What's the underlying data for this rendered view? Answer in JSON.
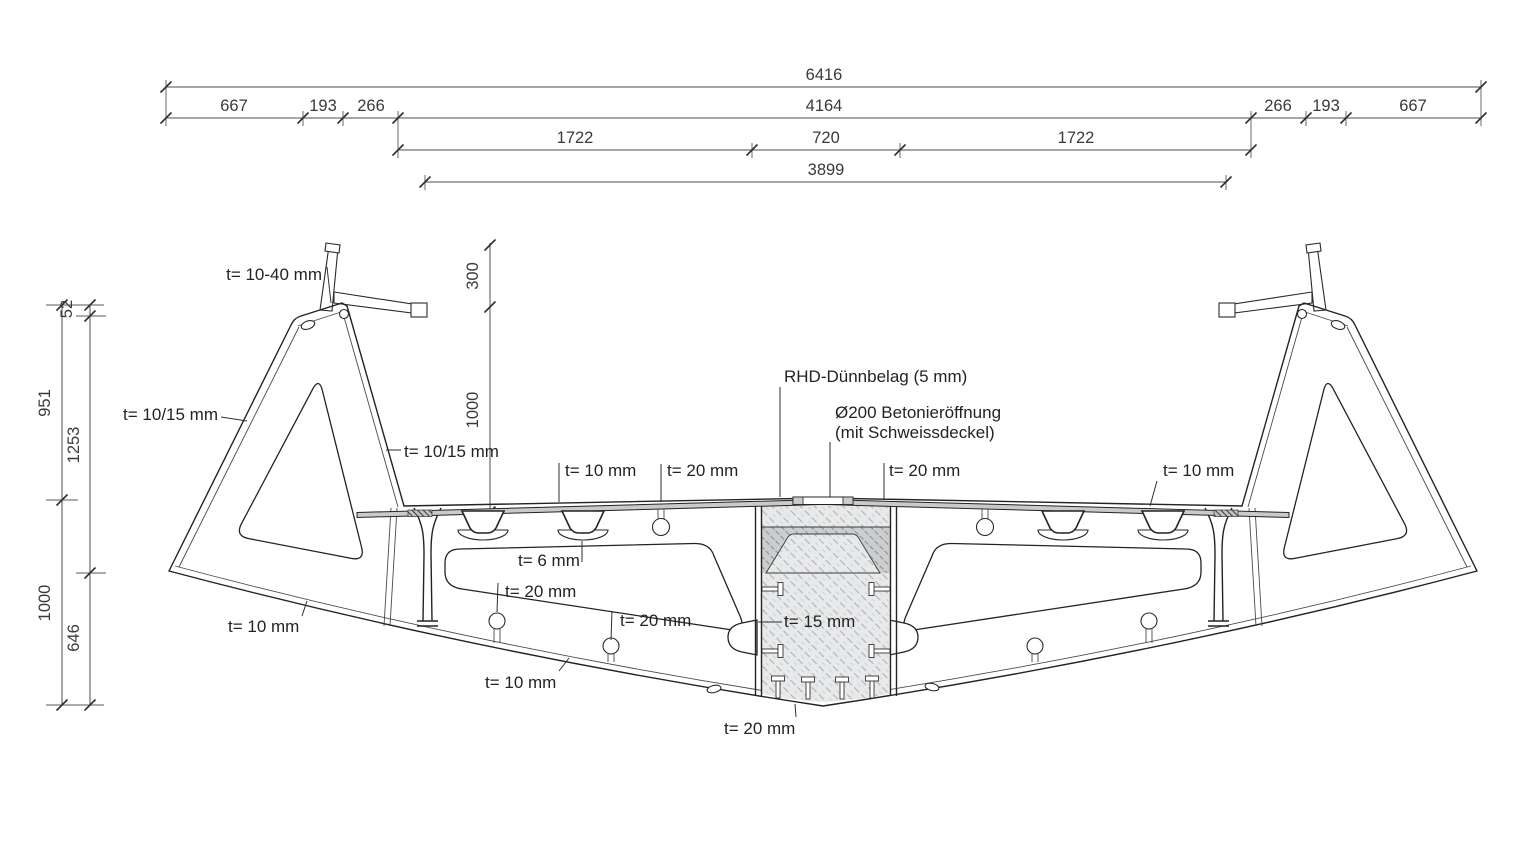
{
  "drawing_type": "bridge box-girder cross-section, dimensioned engineering drawing",
  "colors": {
    "background": "#ffffff",
    "steel_fill": "#d9dadb",
    "deck_fill": "#c8cacc",
    "outline": "#232323",
    "dimension_line": "#4c4c4c",
    "text": "#3a3a3a"
  },
  "dimensions": {
    "top": {
      "overall": "6416",
      "row2": [
        "667",
        "193",
        "266",
        "4164",
        "266",
        "193",
        "667"
      ],
      "row3": [
        "1722",
        "720",
        "1722"
      ],
      "row4": "3899"
    },
    "left": {
      "outer": [
        "951",
        "1000"
      ],
      "inner": [
        "52",
        "1253",
        "646"
      ]
    },
    "middle": [
      "300",
      "1000"
    ]
  },
  "labels": {
    "t_top_plate": "t= 10-40 mm",
    "t_outer_web_left": "t= 10/15 mm",
    "t_inner_web_left": "t= 10/15 mm",
    "t_deck_left": "t= 10 mm",
    "t_rib_deck_left": "t= 20 mm",
    "surfacing": "RHD-Dünnbelag (5 mm)",
    "opening_line1": "Ø200 Betonieröffnung",
    "opening_line2": "(mit Schweissdeckel)",
    "t_deck_center_right": "t= 20 mm",
    "t_deck_right": "t= 10 mm",
    "t_trough": "t= 6 mm",
    "t_bottom_rib_1": "t= 20 mm",
    "t_bottom_rib_2": "t= 20 mm",
    "t_core_web": "t= 15 mm",
    "t_wing_bottom": "t= 10 mm",
    "t_bottom_plate_outer": "t= 10 mm",
    "t_bottom_plate_center": "t= 20 mm"
  }
}
